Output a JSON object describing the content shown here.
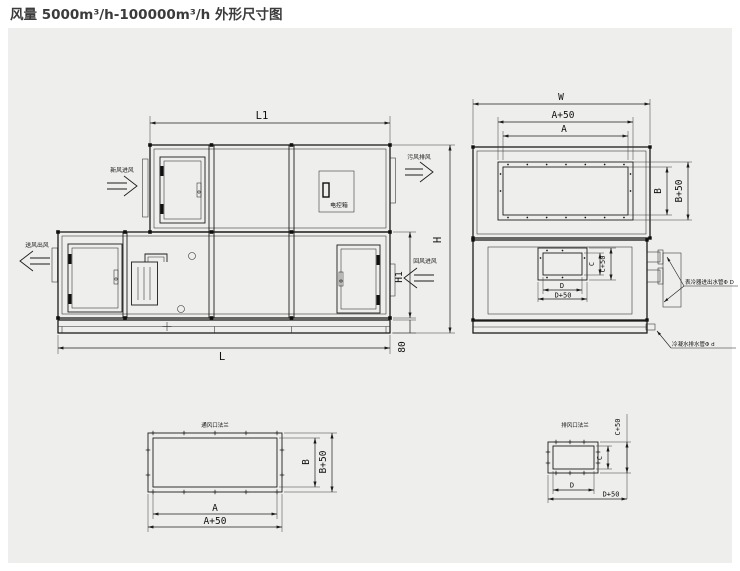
{
  "title": "风量 5000m³/h-100000m³/h 外形尺寸图",
  "colors": {
    "panel_bg": "#eeeeec",
    "line": "#1c1c1c"
  },
  "front": {
    "dims": {
      "l1": "L1",
      "l": "L",
      "h": "H",
      "h1": "H1",
      "base_height": "80"
    },
    "electric_box": "电控箱",
    "flows": {
      "fresh_in": "新风进风",
      "exhaust_out": "污风排风",
      "supply_out": "送风出风",
      "return_in": "回风进风"
    }
  },
  "side": {
    "dims": {
      "w": "W",
      "a": "A",
      "a50": "A+50",
      "b": "B",
      "b50": "B+50",
      "c": "C",
      "c50": "C+50",
      "d": "D",
      "d50": "D+50"
    },
    "callouts": {
      "coil_pipes": "表冷器进出水管Φ D",
      "drain_pipe": "冷凝水排水管Φ d"
    }
  },
  "flange_main": {
    "title": "通风口法兰",
    "dims": {
      "a": "A",
      "a50": "A+50",
      "b": "B",
      "b50": "B+50"
    }
  },
  "flange_small": {
    "title": "排风口法兰",
    "dims": {
      "c": "C",
      "c50": "C+50",
      "d": "D",
      "d50": "D+50"
    }
  }
}
